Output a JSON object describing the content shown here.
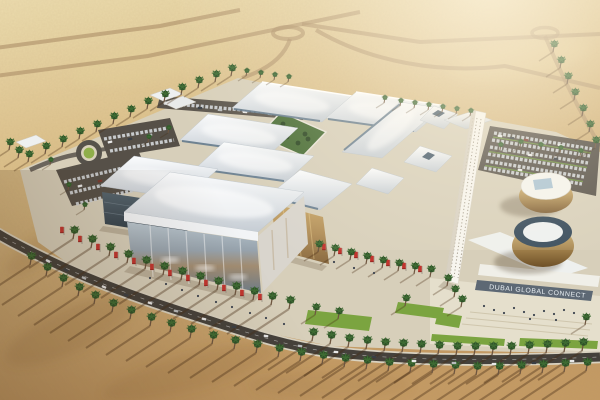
{
  "scene": {
    "sign": {
      "text": "DUBAI GLOBAL CONNECT"
    },
    "palette": {
      "sand-light": "#eedfae",
      "sand-mid": "#d9bb84",
      "sand-dark": "#c49a63",
      "building-white": "#f4f6f8",
      "roof-shade": "#c6cdd4",
      "glass-blue": "#8fa3b2",
      "glass-warm": "#b08d58",
      "asphalt": "#46423c",
      "apron": "#d7cfba",
      "plaza": "#e6dfcc",
      "lawn": "#7ba440",
      "palm-green": "#38632e",
      "banner-red": "#c2342e",
      "gold": "#bb9a5e",
      "skylight-blue": "#5d7488",
      "sign-band": "#5d6874",
      "sign-text": "#e8eef2"
    }
  }
}
